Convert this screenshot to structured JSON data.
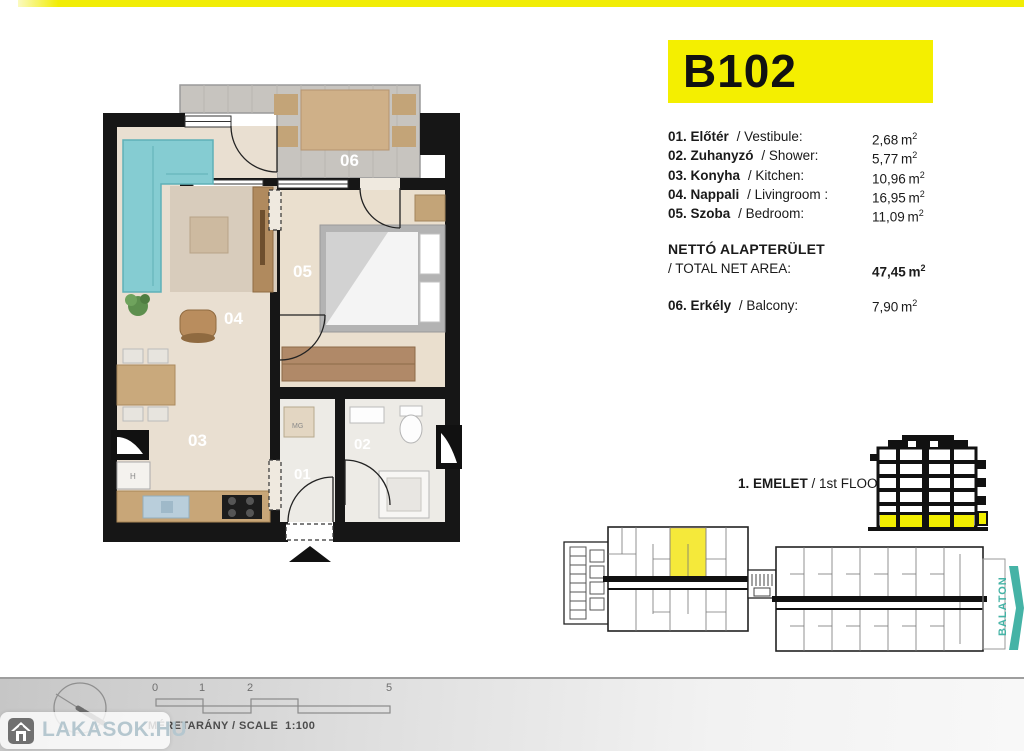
{
  "unit": {
    "id": "B102"
  },
  "rooms": [
    {
      "num": "01.",
      "hu": "Előtér",
      "en": "/ Vestibule:",
      "area": "2,68"
    },
    {
      "num": "02.",
      "hu": "Zuhanyzó",
      "en": "/ Shower:",
      "area": "5,77"
    },
    {
      "num": "03.",
      "hu": "Konyha",
      "en": "/ Kitchen:",
      "area": "10,96"
    },
    {
      "num": "04.",
      "hu": "Nappali",
      "en": "/ Livingroom :",
      "area": "16,95"
    },
    {
      "num": "05.",
      "hu": "Szoba",
      "en": "/ Bedroom:",
      "area": "11,09"
    }
  ],
  "total": {
    "label_hu": "NETTÓ ALAPTERÜLET",
    "label_en": "/ TOTAL NET AREA:",
    "area": "47,45"
  },
  "balcony_row": {
    "num": "06.",
    "hu": "Erkély",
    "en": "/ Balcony:",
    "area": "7,90"
  },
  "units_label": {
    "m": "m",
    "sup": "2"
  },
  "floor": {
    "bold": "1. EMELET",
    "rest": " / 1st FLOOR"
  },
  "plan_labels": {
    "r01": "01",
    "r02": "02",
    "r03": "03",
    "r04": "04",
    "r05": "05",
    "r06": "06",
    "mg": "MG"
  },
  "overview": {
    "balaton": "BALATON"
  },
  "scalebar": {
    "t0": "0",
    "t1": "1",
    "t2": "2",
    "t3": "5",
    "label": "MÉRETARÁNY / SCALE",
    "ratio": "1:100"
  },
  "watermark": {
    "text": "LAKASOK.HU"
  },
  "colors": {
    "accent_yellow": "#f4ef00",
    "teal": "#45b3a6",
    "sofa_teal": "#85ccd2"
  }
}
